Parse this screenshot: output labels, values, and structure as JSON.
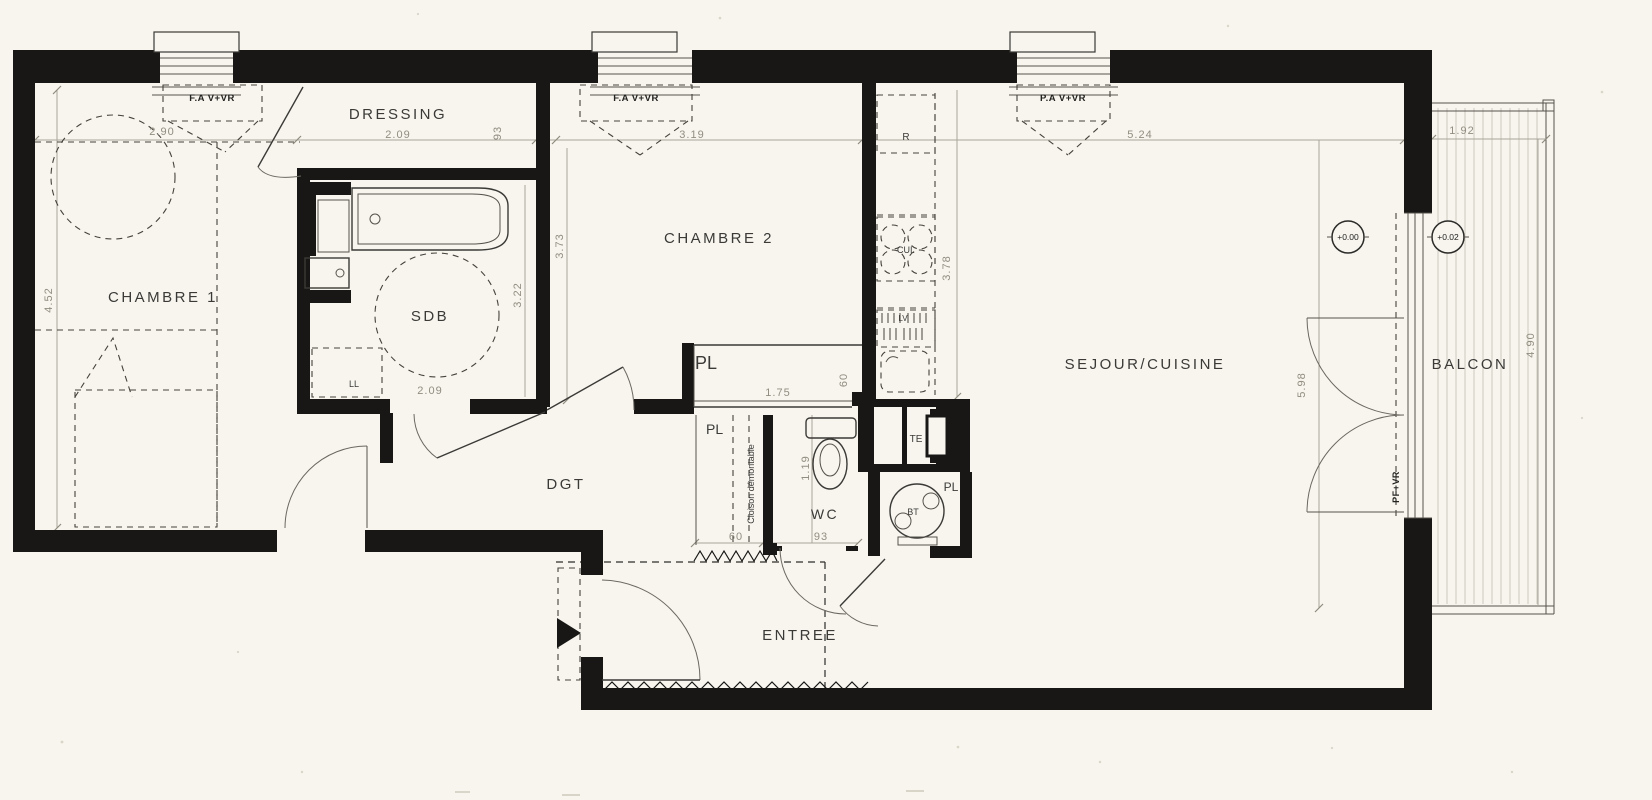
{
  "rooms": {
    "chambre1": "CHAMBRE 1",
    "dressing": "DRESSING",
    "sdb": "SDB",
    "chambre2": "CHAMBRE 2",
    "dgt": "DGT",
    "wc": "WC",
    "entree": "ENTREE",
    "sejour": "SEJOUR/CUISINE",
    "balcon": "BALCON"
  },
  "dims": {
    "c1_w": "2.90",
    "c1_h": "4.52",
    "dressing_w": "2.09",
    "wall93": "93",
    "c2_w": "3.19",
    "c2_h": "3.73",
    "sdb_h": "3.22",
    "sdb_w": "2.09",
    "kitchen_h": "3.78",
    "sejour_w": "5.24",
    "sejour_h": "5.98",
    "balcon_w": "1.92",
    "balcon_h": "4.90",
    "pl_w": "1.75",
    "pl_d": "60",
    "cloison_w": "60",
    "wc_w": "93",
    "wc_h": "1.19"
  },
  "windows": {
    "w1": "F.A V+VR",
    "w2": "F.A V+VR",
    "w3": "P.A V+VR",
    "pf": "PF+VR"
  },
  "fixtures": {
    "fridge": "R",
    "hob": "CUI.",
    "dishwasher": "LV",
    "washer": "LL",
    "boiler": "BT",
    "elec": "TE",
    "pl1": "PL",
    "pl2": "PL",
    "pl3": "PL",
    "cloison": "Cloison démontable"
  },
  "levels": {
    "inside": "+0.00",
    "balcony": "+0.02"
  }
}
